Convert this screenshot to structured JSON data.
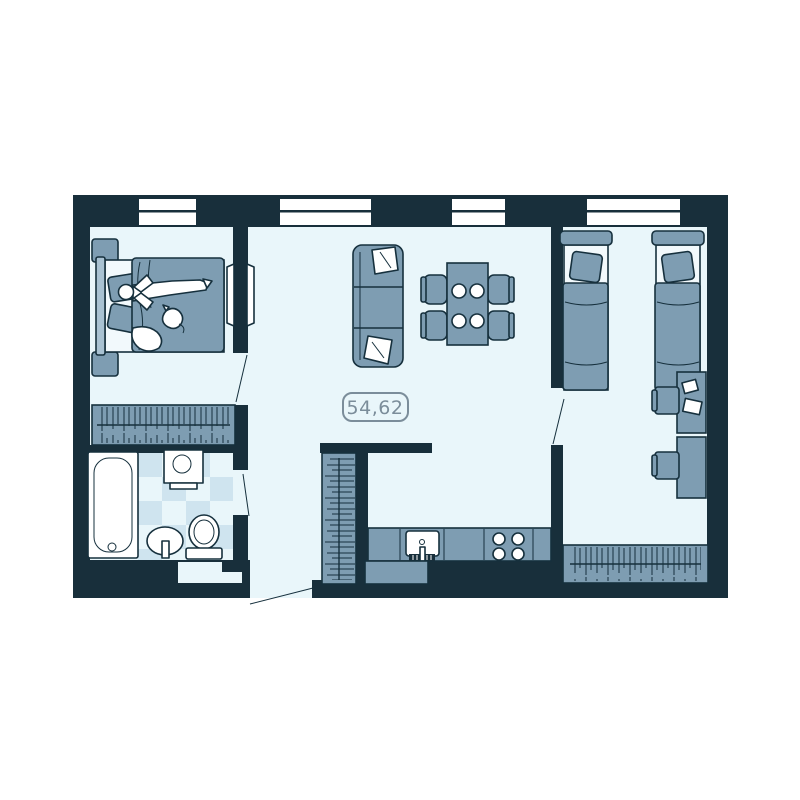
{
  "floor_plan": {
    "area_label": "54,62",
    "windows_count": 4,
    "colors": {
      "wall": "#182f3b",
      "floor": "#e9f6fa",
      "furniture": "#7e9db2",
      "furniture_light": "#a9c2d2",
      "sheet": "#f2f9fc",
      "tile": "#cfe4ef",
      "white": "#ffffff",
      "label": "#7b8d9a",
      "outline": "#16303d"
    },
    "rooms": [
      {
        "name": "bedroom-1",
        "furniture": [
          "double-bed",
          "person-lying",
          "cat",
          "nightstand",
          "nightstand",
          "wardrobe-with-hangers"
        ]
      },
      {
        "name": "living-room",
        "furniture": [
          "three-seat-sofa",
          "two-pillows",
          "dining-table",
          "four-chairs",
          "four-plates"
        ]
      },
      {
        "name": "hallway",
        "furniture": [
          "coat-closet-with-hangers"
        ],
        "doors": [
          "entry-door",
          "bedroom-1-door",
          "bathroom-door",
          "french-door"
        ]
      },
      {
        "name": "kitchen",
        "furniture": [
          "counter",
          "kitchen-sink",
          "stove-four-burners",
          "base-cabinet"
        ]
      },
      {
        "name": "bathroom",
        "floor": "checker-tile",
        "furniture": [
          "bathtub",
          "washing-machine",
          "pedestal-sink",
          "toilet"
        ]
      },
      {
        "name": "bedroom-2",
        "furniture": [
          "single-bed",
          "single-bed",
          "desk-with-papers",
          "desk",
          "two-chairs",
          "wardrobe-with-hangers"
        ],
        "doors": [
          "bedroom-2-door"
        ]
      }
    ]
  }
}
